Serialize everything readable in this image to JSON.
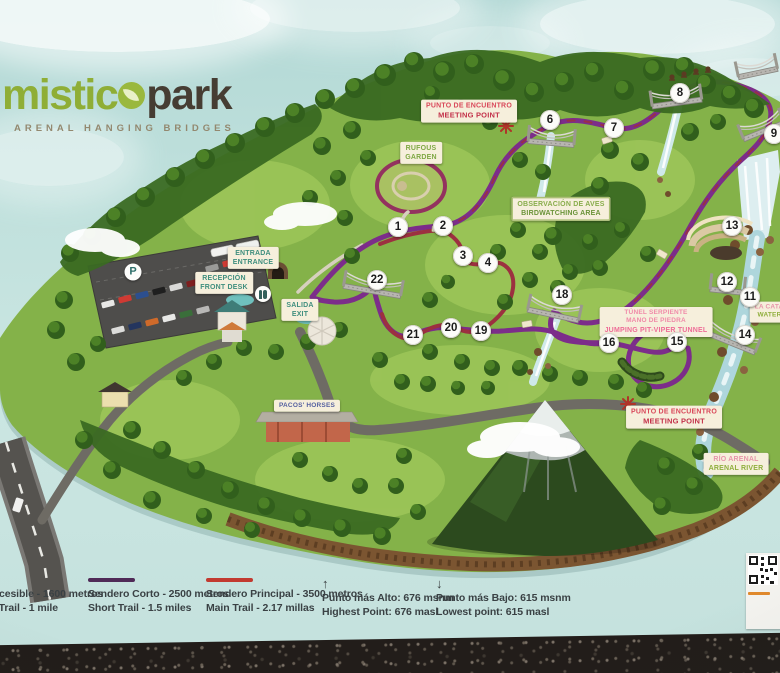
{
  "logo": {
    "word1": "mistic",
    "o": "o",
    "word2": "park",
    "subtitle": "ARENAL HANGING BRIDGES"
  },
  "icons": {
    "parking": "P",
    "arrow_up": "↑",
    "arrow_down": "↓"
  },
  "colors": {
    "brand_green": "#8fae36",
    "brand_dark": "#463d33",
    "trail_short_purple": "#7c2d8a",
    "trail_main_red": "#9c3040",
    "legend_purple": "#4f2a57",
    "legend_red": "#c23a30",
    "label_green": "#7fa844",
    "label_teal": "#3f8e7e",
    "label_red": "#d94b5c",
    "label_pink": "#ef6e9a"
  },
  "map": {
    "markers": [
      {
        "n": "1",
        "x": 398,
        "y": 227
      },
      {
        "n": "2",
        "x": 443,
        "y": 226
      },
      {
        "n": "3",
        "x": 463,
        "y": 256
      },
      {
        "n": "4",
        "x": 488,
        "y": 263
      },
      {
        "n": "6",
        "x": 550,
        "y": 120
      },
      {
        "n": "7",
        "x": 614,
        "y": 128
      },
      {
        "n": "8",
        "x": 680,
        "y": 93
      },
      {
        "n": "9",
        "x": 774,
        "y": 134
      },
      {
        "n": "11",
        "x": 750,
        "y": 297
      },
      {
        "n": "12",
        "x": 727,
        "y": 282
      },
      {
        "n": "13",
        "x": 732,
        "y": 226
      },
      {
        "n": "14",
        "x": 745,
        "y": 335
      },
      {
        "n": "15",
        "x": 677,
        "y": 342
      },
      {
        "n": "16",
        "x": 609,
        "y": 343
      },
      {
        "n": "18",
        "x": 562,
        "y": 295
      },
      {
        "n": "19",
        "x": 481,
        "y": 331
      },
      {
        "n": "20",
        "x": 451,
        "y": 328
      },
      {
        "n": "21",
        "x": 413,
        "y": 335
      },
      {
        "n": "22",
        "x": 377,
        "y": 280
      }
    ],
    "labels": [
      {
        "id": "meeting-point-top",
        "cx": 469,
        "cy": 111,
        "lines": [
          {
            "t": "PUNTO DE ENCUENTRO",
            "c": "#d9485a"
          },
          {
            "t": "MEETING POINT",
            "c": "#c3324a",
            "s": 7.5
          }
        ]
      },
      {
        "id": "rufous-garden",
        "cx": 421,
        "cy": 153,
        "lines": [
          {
            "t": "RUFOUS",
            "c": "#7fa844"
          },
          {
            "t": "GARDEN",
            "c": "#7fa844"
          }
        ]
      },
      {
        "id": "birdwatching-area",
        "cx": 561,
        "cy": 209,
        "bordered": true,
        "lines": [
          {
            "t": "OBSERVACIÓN DE AVES",
            "c": "#89ad4c"
          },
          {
            "t": "BIRDWATCHING AREA",
            "c": "#6a9338"
          }
        ]
      },
      {
        "id": "entrance",
        "cx": 253,
        "cy": 258,
        "lines": [
          {
            "t": "ENTRADA",
            "c": "#3f8e7e"
          },
          {
            "t": "ENTRANCE",
            "c": "#3f8e7e"
          }
        ]
      },
      {
        "id": "front-desk",
        "cx": 224,
        "cy": 283,
        "lines": [
          {
            "t": "RECEPCIÓN",
            "c": "#3f8e7e"
          },
          {
            "t": "FRONT DESK",
            "c": "#3f8e7e"
          }
        ]
      },
      {
        "id": "exit",
        "cx": 300,
        "cy": 310,
        "lines": [
          {
            "t": "SALIDA",
            "c": "#3f8e7e"
          },
          {
            "t": "EXIT",
            "c": "#3f8e7e"
          }
        ]
      },
      {
        "id": "pit-viper-tunnel",
        "cx": 656,
        "cy": 322,
        "small": true,
        "lines": [
          {
            "t": "TÚNEL SERPIENTE",
            "c": "#f08aa8"
          },
          {
            "t": "MANO DE PIEDRA",
            "c": "#f08aa8"
          },
          {
            "t": "JUMPING PIT-VIPER TUNNEL",
            "c": "#ee6d97",
            "s": 7
          }
        ]
      },
      {
        "id": "meeting-point-bottom",
        "cx": 674,
        "cy": 417,
        "lines": [
          {
            "t": "PUNTO DE ENCUENTRO",
            "c": "#d9485a"
          },
          {
            "t": "MEETING POINT",
            "c": "#c3324a",
            "s": 7.5
          }
        ]
      },
      {
        "id": "rio-arenal",
        "cx": 736,
        "cy": 464,
        "lines": [
          {
            "t": "RÍO ARENAL",
            "c": "#e795aa"
          },
          {
            "t": "ARENAL RIVER",
            "c": "#8fae3c"
          }
        ]
      },
      {
        "id": "waterfall",
        "cx": 778,
        "cy": 312,
        "small": true,
        "lines": [
          {
            "t": "LA CATARATA",
            "c": "#e795aa"
          },
          {
            "t": "WATERFALL",
            "c": "#8fae3c"
          }
        ]
      },
      {
        "id": "pacos-horses",
        "cx": 307,
        "cy": 406,
        "small": true,
        "lines": [
          {
            "t": "PACOS' HORSES",
            "c": "#5560a0"
          }
        ]
      }
    ]
  },
  "legend": {
    "items": [
      {
        "id": "accessible-trail",
        "x": -58,
        "kind": "line",
        "color": "",
        "es": "Sendero Accesible - 1600 metros",
        "en": "Accessible Trail - 1 mile"
      },
      {
        "id": "short-trail",
        "x": 88,
        "kind": "line",
        "color": "#4f2a57",
        "es": "Sendero Corto - 2500 metros",
        "en": "Short Trail - 1.5 miles"
      },
      {
        "id": "main-trail",
        "x": 206,
        "kind": "line",
        "color": "#c23a30",
        "es": "Sendero Principal - 3500 metros",
        "en": "Main Trail - 2.17 millas"
      },
      {
        "id": "highest-point",
        "x": 322,
        "kind": "arrow",
        "dir": "up",
        "es": "Punto más Alto: 676 msnm",
        "en": "Highest Point: 676 masl"
      },
      {
        "id": "lowest-point",
        "x": 436,
        "kind": "arrow",
        "dir": "down",
        "es": "Punto más Bajo: 615 msnm",
        "en": "Lowest point: 615 masl"
      }
    ]
  }
}
